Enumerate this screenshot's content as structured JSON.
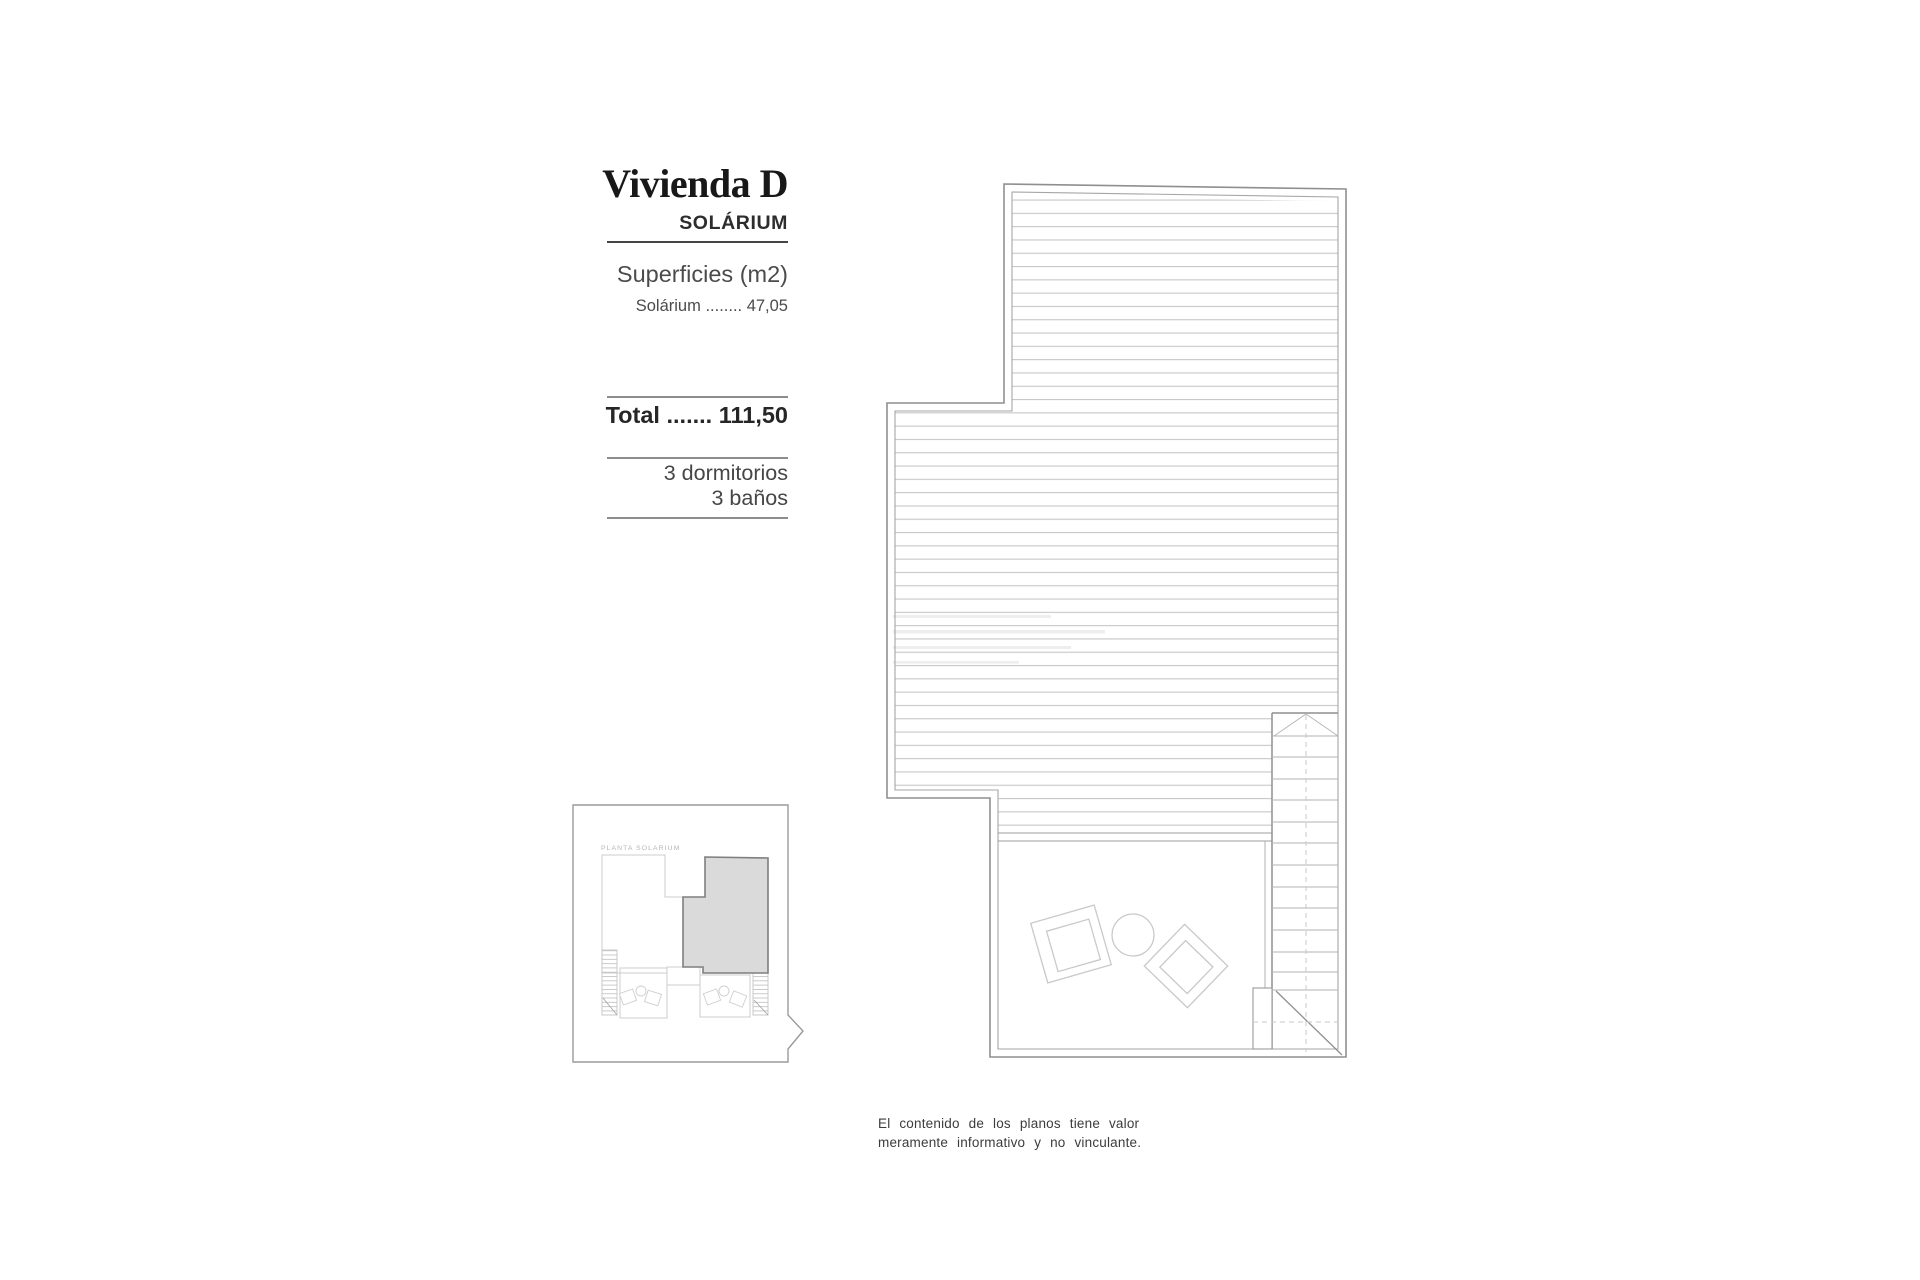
{
  "title_block": {
    "title": "Vivienda D",
    "subtitle": "SOLÁRIUM",
    "surfaces_heading": "Superficies (m2)",
    "surface_row": "Solárium ........ 47,05",
    "total": "Total ....... 111,50",
    "bedrooms": "3 dormitorios",
    "bathrooms": "3 baños"
  },
  "key_plan": {
    "label": "PLANTA SOLARIUM"
  },
  "disclaimer": {
    "line1": "El contenido de los planos tiene valor",
    "line2": "meramente informativo y no vinculante."
  },
  "colors": {
    "background": "#ffffff",
    "title_text": "#181818",
    "body_text": "#4b4b4b",
    "rule_dark": "#454545",
    "rule_light": "#8d8d8d",
    "plan_wall": "#8f8f8f",
    "plan_inner_wall": "#a6a6a6",
    "hatch_line": "#c7c7c7",
    "furniture_line": "#c9c9c9",
    "stair_tread": "#b3b3b3",
    "dashed_line": "#c9c9c9",
    "keyplan_border": "#9a9a9a",
    "keyplan_unit_line": "#cccccc",
    "keyplan_label": "#b5b5b5",
    "highlight_fill": "#dadada",
    "highlight_stroke": "#7f7f7f"
  }
}
